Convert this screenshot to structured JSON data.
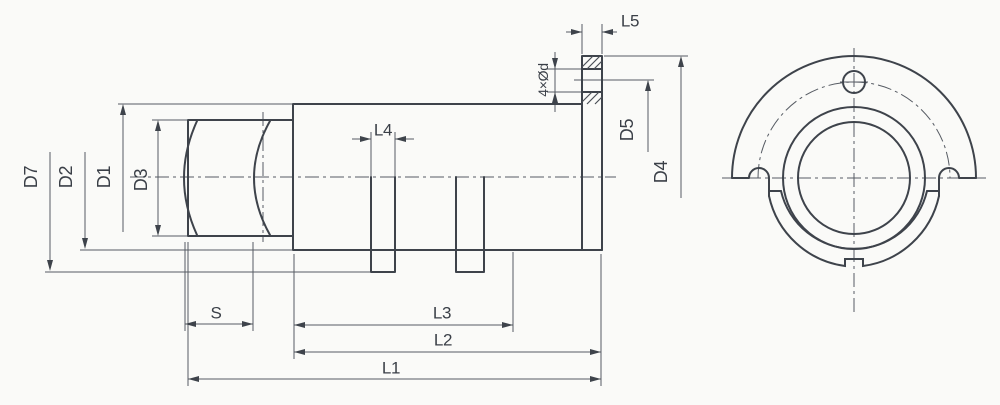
{
  "drawing_title": "flanged spherical-seat housing, dimensioned 2-view technical drawing",
  "colors": {
    "ink": "#3e434b",
    "thin_line": "#565b63",
    "paper": "#fafaf8"
  },
  "labels": {
    "d7": "D7",
    "d2": "D2",
    "d1": "D1",
    "d3": "D3",
    "s": "S",
    "l1": "L1",
    "l2": "L2",
    "l3": "L3",
    "l4": "L4",
    "l5": "L5",
    "bolt_holes": "4×Ød",
    "d5": "D5",
    "d4": "D4"
  }
}
